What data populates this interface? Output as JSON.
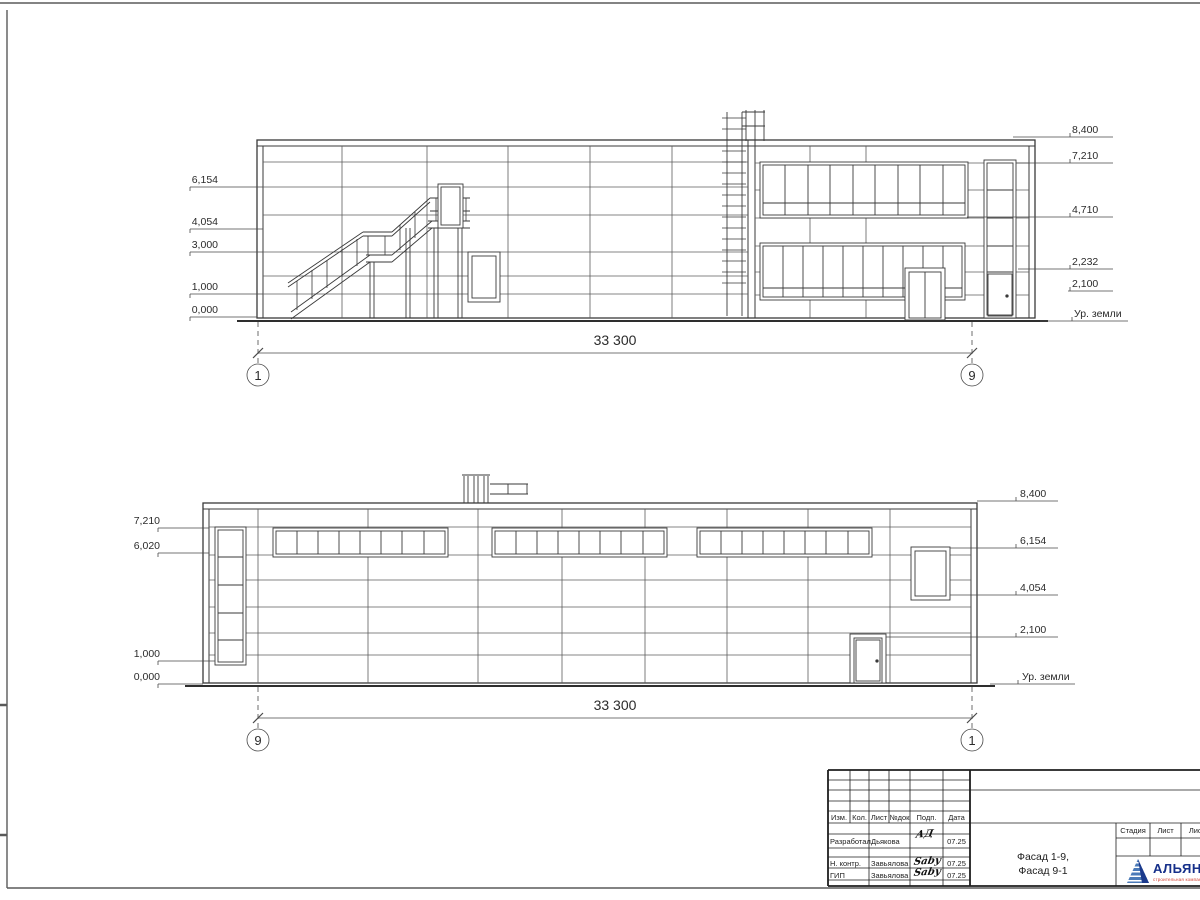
{
  "top_facade": {
    "elevations_left": [
      "6,154",
      "4,054",
      "3,000",
      "1,000",
      "0,000"
    ],
    "elevations_right": [
      "8,400",
      "7,210",
      "4,710",
      "2,232",
      "2,100"
    ],
    "ground_label": "Ур. земли",
    "dimension": "33 300",
    "axis_left": "1",
    "axis_right": "9"
  },
  "bottom_facade": {
    "elevations_left": [
      "7,210",
      "6,020",
      "1,000",
      "0,000"
    ],
    "elevations_right": [
      "8,400",
      "6,154",
      "4,054",
      "2,100"
    ],
    "ground_label": "Ур. земли",
    "dimension": "33 300",
    "axis_left": "9",
    "axis_right": "1"
  },
  "title_block": {
    "header_cols": [
      "Изм.",
      "Кол.",
      "Лист",
      "№док",
      "Подп.",
      "Дата"
    ],
    "rows": [
      {
        "role": "Разработал",
        "name": "Дьякова",
        "signature": "АД",
        "date": "07.25"
      },
      {
        "role": "Н. контр.",
        "name": "Завьялова",
        "signature": "Saby",
        "date": "07.25"
      },
      {
        "role": "ГИП",
        "name": "Завьялова",
        "signature": "Saby",
        "date": "07.25"
      }
    ],
    "drawing_title_line1": "Фасад 1-9,",
    "drawing_title_line2": "Фасад 9-1",
    "stage_cols": [
      "Стадия",
      "Лист",
      "Листов"
    ],
    "logo": {
      "name": "АЛЬЯНС",
      "subtitle": "строительная компания"
    }
  }
}
